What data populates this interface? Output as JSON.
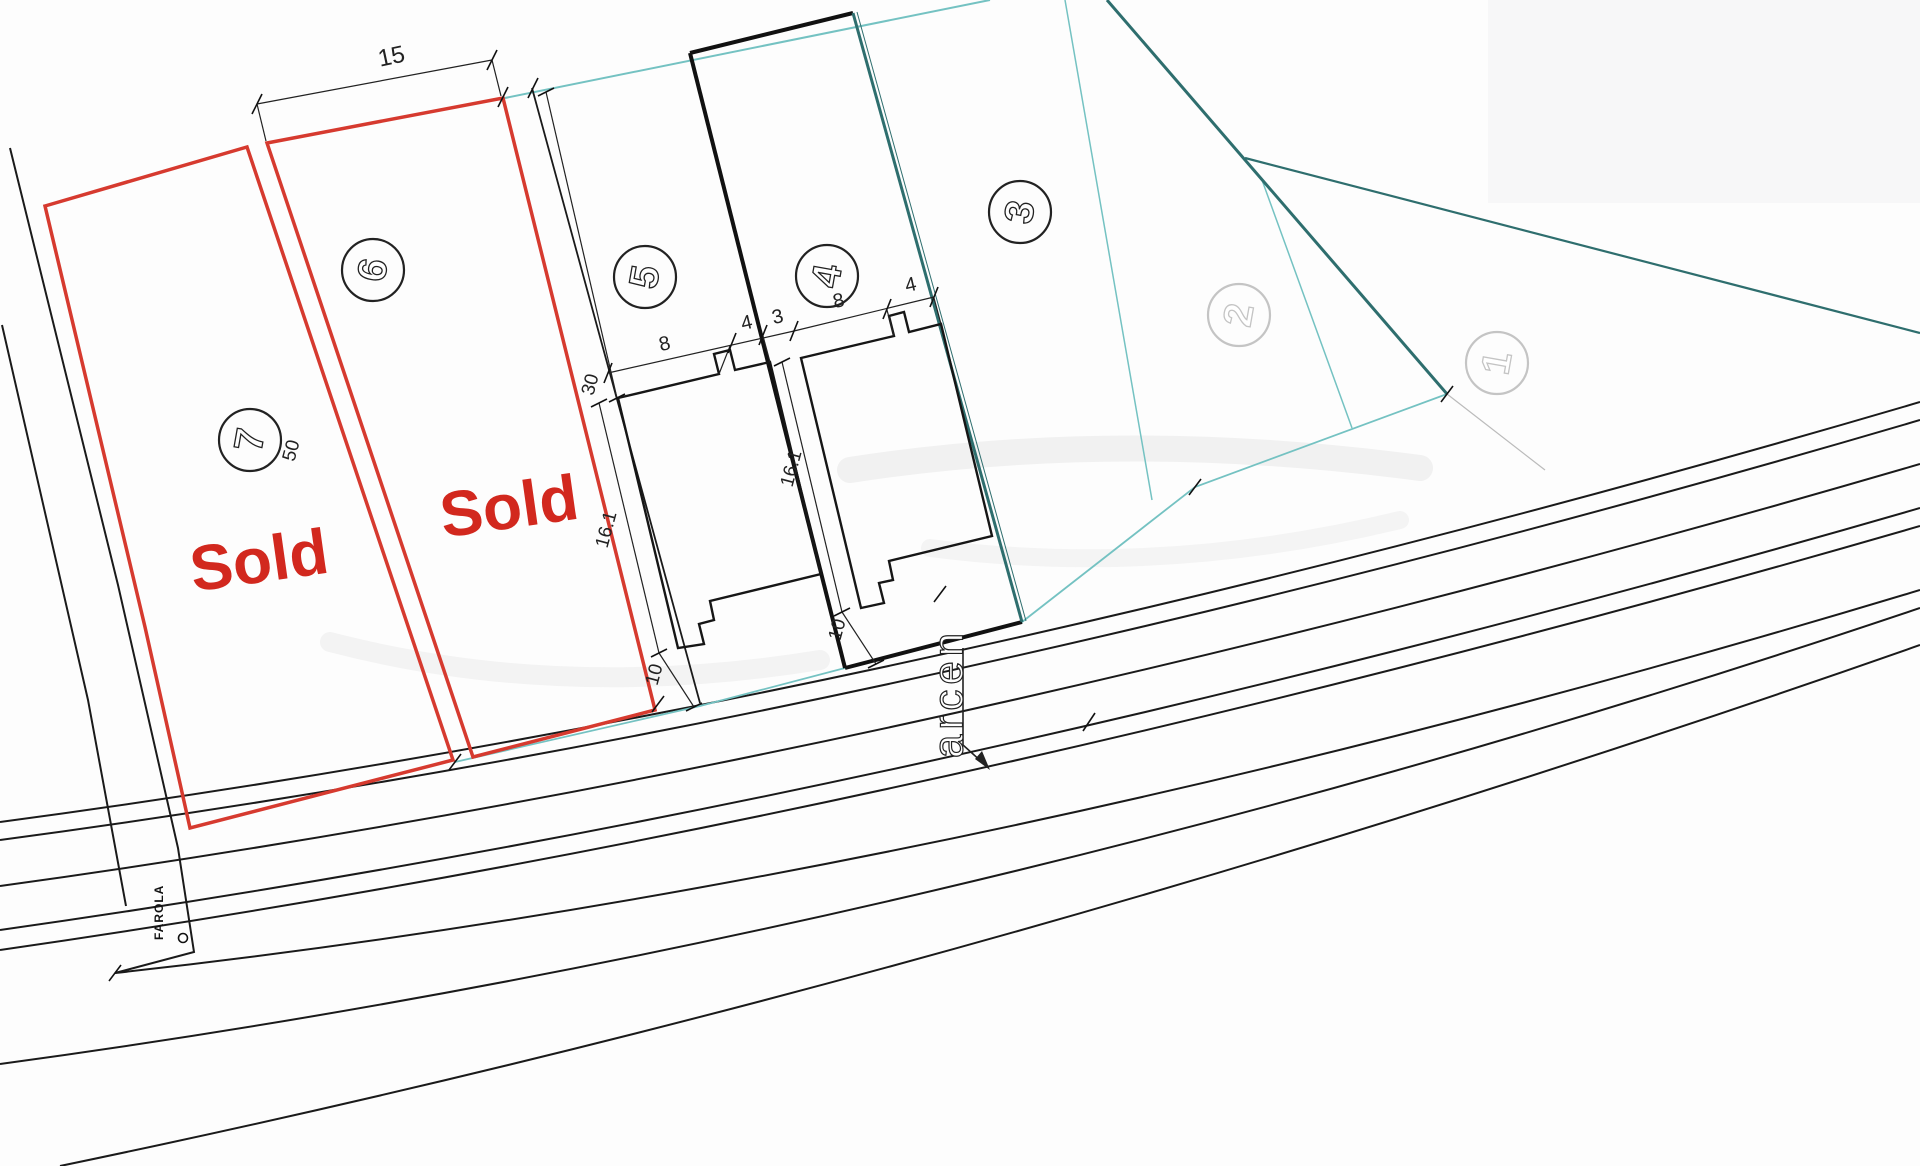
{
  "document": {
    "type": "site-plan-drawing"
  },
  "colors": {
    "plot_outline_red": "#d63a2f",
    "sold_red": "#d2281e",
    "boundary_teal_light": "#74c2c2",
    "boundary_teal_dark": "#2e6e6e",
    "line_black": "#1a1a1a",
    "faint_gray": "#c4c4c4"
  },
  "labels": {
    "sold": "Sold",
    "shoulder": "arcen",
    "streetlight": "FAROLA"
  },
  "plots": [
    {
      "number": "1",
      "status": ""
    },
    {
      "number": "2",
      "status": ""
    },
    {
      "number": "3",
      "status": ""
    },
    {
      "number": "4",
      "status": ""
    },
    {
      "number": "5",
      "status": ""
    },
    {
      "number": "6",
      "status": "Sold"
    },
    {
      "number": "7",
      "status": "Sold"
    }
  ],
  "dimensions": {
    "lot_width": "15",
    "lot_depth": "50",
    "setback": "30",
    "house_gap": "3",
    "house": {
      "front_left": "8",
      "front_right": "4",
      "side": "16.1",
      "rear": "10"
    }
  }
}
